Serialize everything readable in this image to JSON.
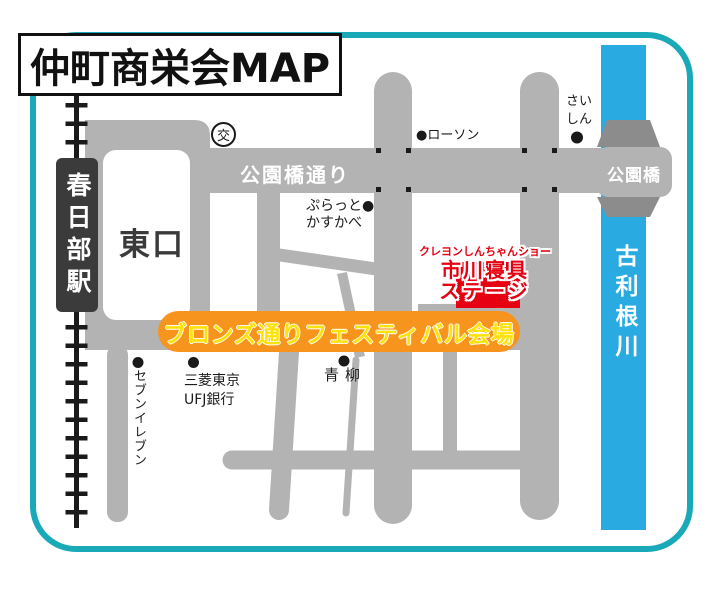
{
  "map_title": "仲町商栄会MAP",
  "station": {
    "name": "春日部駅",
    "exit_label": "東口"
  },
  "police_box_label": "交",
  "streets": {
    "koenbashi_dori": "公園橋通り",
    "bridge_label": "公園橋"
  },
  "river_name": "古利根川",
  "festival_banner": "ブロンズ通りフェスティバル会場",
  "stage": {
    "show_line": "クレヨンしんちゃんショー",
    "venue_line": "市川寝具",
    "stage_line": "ステージ"
  },
  "pois": {
    "lawson": "●ローソン",
    "platto_line1": "ぷらっと●",
    "platto_line2": "かすかべ",
    "saishin_line1": "さい",
    "saishin_line2": "しん",
    "seven_eleven": "セブンイレブン",
    "bank_line1": "三菱東京",
    "bank_line2": "UFJ銀行",
    "aoyagi": "青柳"
  },
  "colors": {
    "road_gray": "#b3b3b3",
    "bridge_dark_gray": "#8c8c8c",
    "river_blue": "#29abe2",
    "border_teal": "#1aa9b8",
    "banner_orange": "#f6941d",
    "banner_text_yellow": "#ffe10a",
    "stage_red": "#e60012",
    "station_dark": "#3b3b3b",
    "railway_black": "#1a1a1a"
  }
}
